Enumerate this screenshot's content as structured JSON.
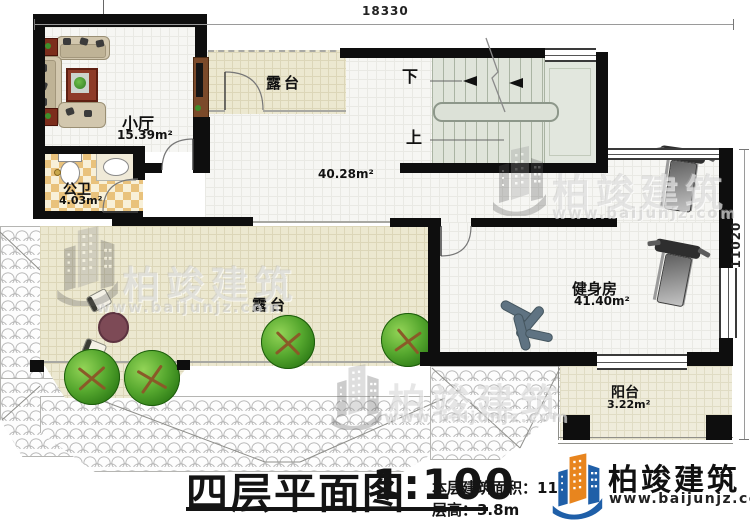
{
  "dimensions": {
    "width": "18330",
    "height": "11020"
  },
  "rooms": {
    "living": {
      "name": "小厅",
      "area": "15.39m²"
    },
    "bath": {
      "name": "公卫",
      "area": "4.03m²"
    },
    "terrace_top": {
      "name": "露台"
    },
    "hall": {
      "area": "40.28m²"
    },
    "gym": {
      "name": "健身房",
      "area": "41.40m²"
    },
    "terrace_main": {
      "name": "露台"
    },
    "balcony": {
      "name": "阳台",
      "area": "3.22m²"
    }
  },
  "stairs": {
    "down": "下",
    "up": "上"
  },
  "title_block": {
    "title": "四层平面图",
    "scale": "1:100",
    "area_line": "本层建筑面积：112",
    "height_line": "层高：3.8m"
  },
  "branding": {
    "name": "柏竣建筑",
    "site": "www.baijunjz.com"
  },
  "watermark": {
    "name": "柏竣建筑",
    "site": "www.baijunjz.com"
  },
  "colors": {
    "logo_blue": "#1f5fa8",
    "logo_orange": "#e8851e",
    "wall": "#0e0e0e"
  }
}
